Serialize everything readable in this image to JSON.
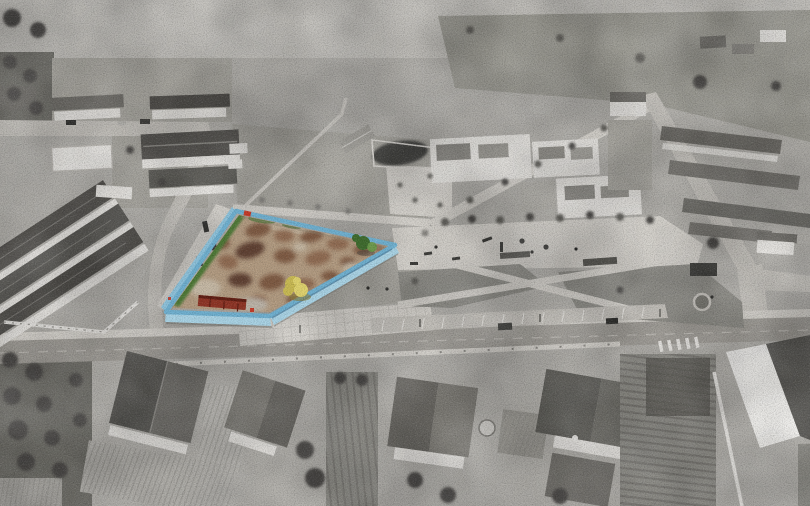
{
  "image": {
    "type": "aerial-drone-photograph",
    "treatment": "grayscale background with selective color highlight on one land parcel"
  },
  "colors": {
    "ground": "#b3b1ac",
    "strip": "#c3c1bc",
    "field": "#9b9a92",
    "field_light": "#a9a7a0",
    "scrub": "#a7a59e",
    "grass_gray": "#8e8d87",
    "orchard": "#6e6d67",
    "orchard_dark": "#55544f",
    "road_asphalt": "#a19e98",
    "road_light": "#c6c3bd",
    "paving": "#d7d4ce",
    "paving_bright": "#ebe9e5",
    "white_wall": "#e8e6e2",
    "white_bright": "#f2f1ee",
    "roof_dark": "#514f4b",
    "roof_mid": "#6e6c67",
    "roof_light": "#8b8984",
    "tree_gray_dark": "#4b4a46",
    "tree_gray": "#5e5d58",
    "shadow": "#3a3a37",
    "car_dark": "#2e2e2c",
    "line_white": "#eceae6",
    "fence_top": "#6fb0d0",
    "fence_face_light": "#a9d3e5",
    "fence_face_mid": "#8cc1da",
    "fence_shadow": "#4e7f9e",
    "dirt_tan": "#b29b81",
    "dirt_brown": "#7e5a43",
    "dirt_brown2": "#8f6a51",
    "dirt_dark": "#5e4130",
    "dirt_light": "#c6b9a5",
    "concrete_pale": "#bcb4a8",
    "weed_green": "#4e7836",
    "tree_green": "#3e6b2d",
    "tree_green_light": "#679b47",
    "tree_yellow": "#c9ba52",
    "tree_yellow_light": "#e0d36d",
    "tree_yellow_shadow": "#8a7d38",
    "shed_red": "#8e3425",
    "shed_red_dark": "#5f1d12",
    "marker_red": "#c43a28"
  }
}
